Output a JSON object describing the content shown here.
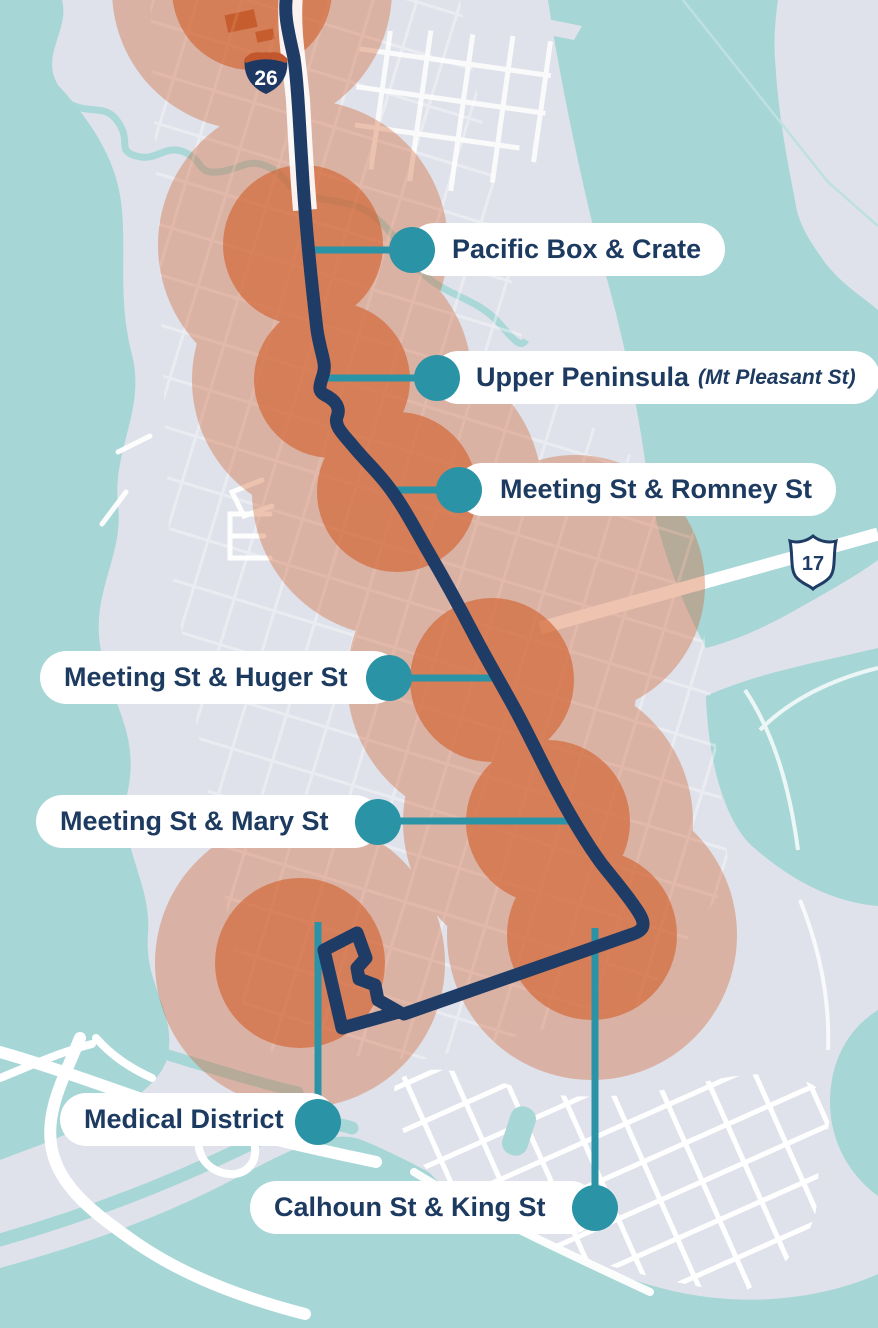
{
  "map": {
    "kind": "transit-route-map",
    "stops": [
      {
        "label": "Pacific Box & Crate"
      },
      {
        "label": "Upper Peninsula",
        "sublabel": "(Mt Pleasant St)"
      },
      {
        "label": "Meeting St & Romney St"
      },
      {
        "label": "Meeting St & Huger St"
      },
      {
        "label": "Meeting St & Mary St"
      },
      {
        "label": "Medical District"
      },
      {
        "label": "Calhoun St & King St"
      }
    ],
    "shields": {
      "interstate_26": "26",
      "us_17": "17"
    },
    "colors": {
      "water": "#a7d6d7",
      "land": "#dfe2ea",
      "coverage_orange": "#d25f2b",
      "route_navy": "#1e3c66",
      "stop_teal": "#2b93a6",
      "label_text": "#1d3a60",
      "interstate_shield_top": "#c2572e",
      "road": "#ffffff"
    }
  }
}
